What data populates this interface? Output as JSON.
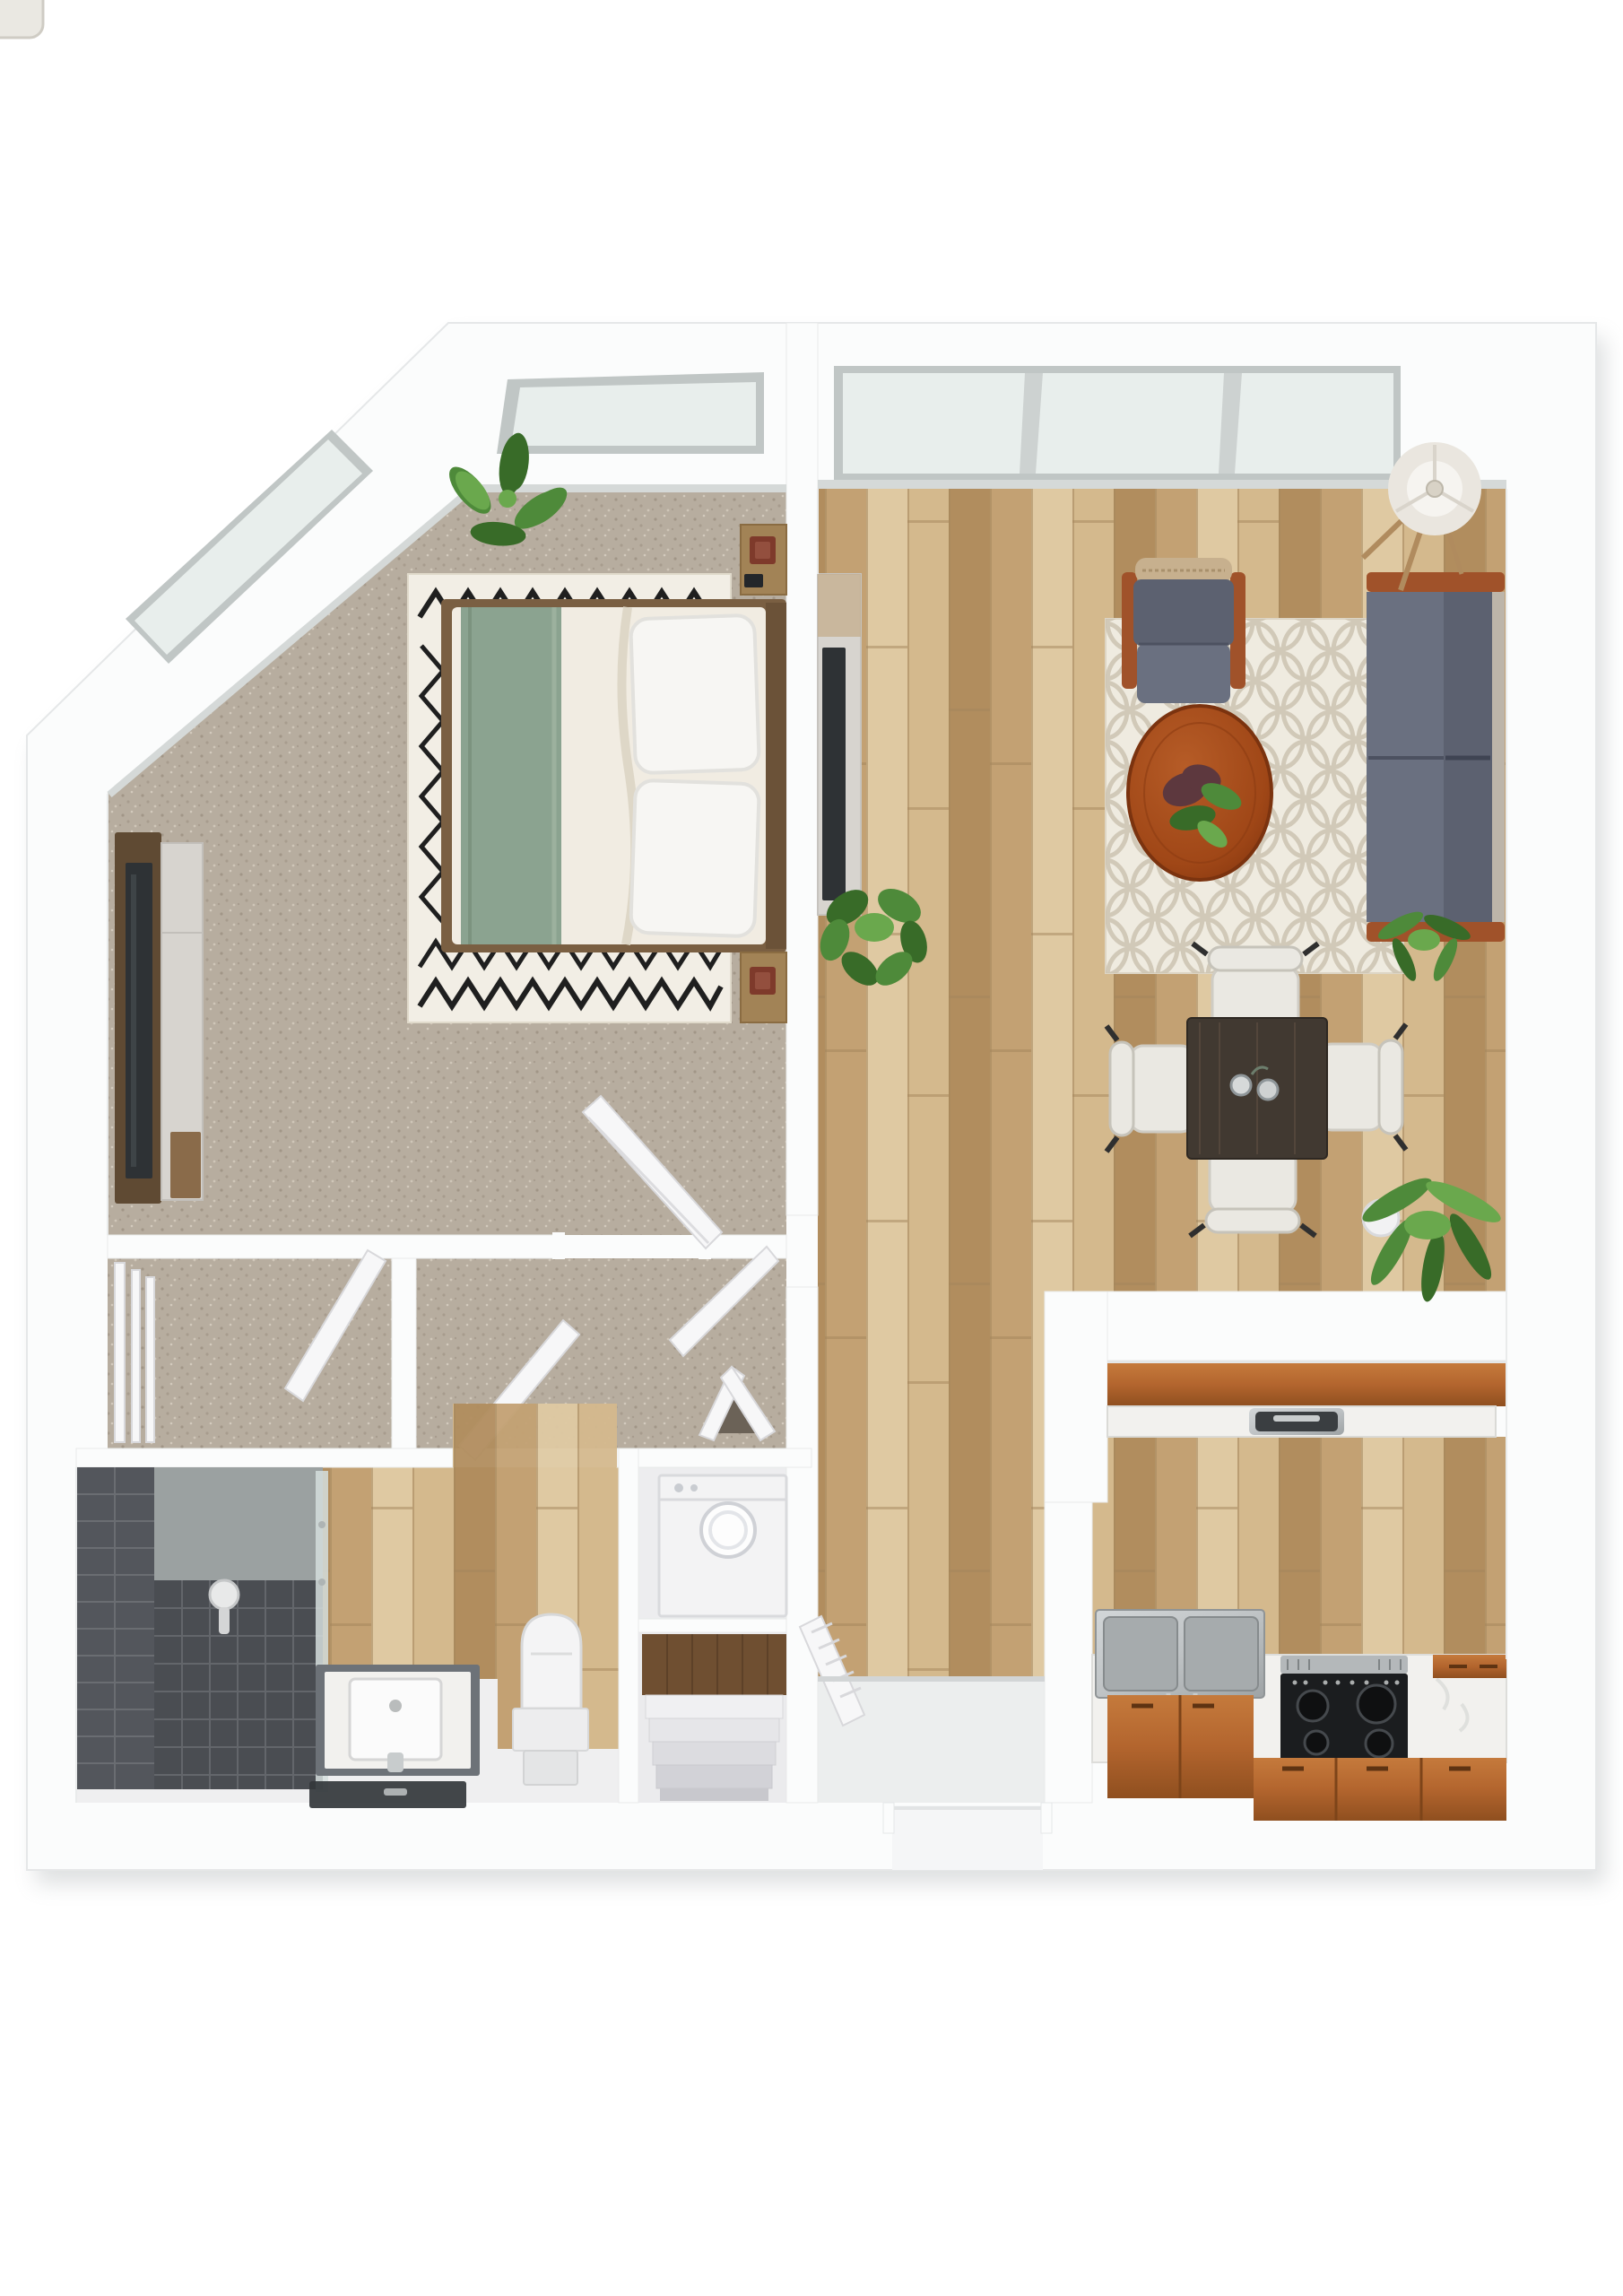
{
  "image_type": "3d-floor-plan-rendering",
  "visible_text": [],
  "palette": {
    "bg": "#ffffff",
    "wall": "#fbfcfc",
    "wall_edge": "#e5e7e8",
    "shadow": "#9aa0a3",
    "carpet": "#b7ad9f",
    "carpet_dot1": "#978c7d",
    "carpet_dot2": "#d9d1c4",
    "wood1": "#d4b98d",
    "wood2": "#c3a173",
    "wood3": "#b18d5e",
    "wood4": "#dfc9a2",
    "wood_joint": "#a3865c",
    "glass": "#e8eeec",
    "window_frame": "#c0c6c5",
    "sill": "#d5d9d8",
    "rug_bedroom": "#f2eee5",
    "rug_zigzag": "#1f1f1f",
    "rug_living": "#efebe0",
    "rug_trellis": "#ccc3b1",
    "sofa_gray": "#5c6170",
    "sofa_gray_light": "#6a7080",
    "sofa_side_fabric": "#bdb5a9",
    "frame_wood": "#a0522a",
    "chair_wicker": "#c7b08e",
    "bed_duvet": "#f1ece2",
    "bed_blanket": "#8ba390",
    "pillow": "#f7f6f3",
    "bed_frame": "#7a5f42",
    "headboard": "#6b5238",
    "nightstand_wood": "#a28356",
    "lamp_red": "#7e3a2b",
    "tv_screen": "#2e3235",
    "console_dark_wood": "#5f4a33",
    "console_light": "#d7d4cf",
    "marble": "#f2f1ee",
    "cabinet_orange": "#b3652e",
    "cabinet_orange_light": "#c57a3c",
    "cabinet_orange_dark": "#8f4f1f",
    "stainless": "#bfc3c5",
    "basin_steel": "#a6abad",
    "stove_black": "#1b1d1f",
    "burner": "#0f1011",
    "burner_ring": "#45494d",
    "door_white": "#f7f7f8",
    "door_edge": "#d8d8db",
    "toilet_white": "#f4f4f5",
    "washer_white": "#f3f3f4",
    "tile_dark": "#53565c",
    "tile_line": "#6a6d72",
    "tile_floor": "#4a4d52",
    "shower_glass": "#d5dedd",
    "vanity_base": "#6d7278",
    "plant_green1": "#4e8a3a",
    "plant_green2": "#386b28",
    "plant_green3": "#6aa84d",
    "plant_dark": "#5d383e",
    "dining_table": "#413931",
    "chair_white": "#eae8e2",
    "lamp_shade": "#eae6df",
    "stairs_wood": "#6f4f31",
    "entry_tile": "#eceeee"
  },
  "floor_plan": {
    "rooms": [
      {
        "name": "bedroom",
        "floor": "carpet",
        "features": [
          "chamfered-corner-wall",
          "skylight-window-diagonal",
          "skylight-window-top"
        ],
        "furniture": [
          "double-bed",
          "zigzag-area-rug",
          "nightstand-top",
          "nightstand-bottom",
          "table-lamp-red-top",
          "table-lamp-red-bottom",
          "tv-console",
          "wall-tv",
          "potted-plant",
          "open-door"
        ]
      },
      {
        "name": "living-room",
        "floor": "wood-planks",
        "features": [
          "panoramic-window-3-pane"
        ],
        "furniture": [
          "armchair",
          "loveseat-sofa",
          "round-coffee-table",
          "coffee-table-plant",
          "trellis-area-rug",
          "floor-lamp-ring",
          "tv-console",
          "wall-tv",
          "fiddle-leaf-plant",
          "small-palm-plant"
        ]
      },
      {
        "name": "dining-area",
        "floor": "wood-planks",
        "furniture": [
          "dining-table",
          "dining-chair-top",
          "dining-chair-bottom",
          "dining-chair-left",
          "dining-chair-right",
          "condiment-jars",
          "palm-plant"
        ]
      },
      {
        "name": "hallway",
        "floor": "carpet",
        "furniture": [
          "open-door-to-bathroom",
          "open-door-to-living",
          "bifold-door",
          "wood-threshold"
        ]
      },
      {
        "name": "closet",
        "floor": "carpet",
        "furniture": [
          "sliding-door-frames",
          "open-door"
        ]
      },
      {
        "name": "bathroom",
        "floor": "wood-and-tile",
        "furniture": [
          "walk-in-shower-dark-tile",
          "glass-shower-panel",
          "shower-fixture",
          "vanity-with-sink",
          "faucet",
          "dark-glass-ledge",
          "toilet"
        ]
      },
      {
        "name": "laundry-nook",
        "floor": "white",
        "furniture": [
          "top-load-washer"
        ]
      },
      {
        "name": "stair-nook",
        "floor": "white",
        "furniture": [
          "wood-landing",
          "descending-steps"
        ]
      },
      {
        "name": "entry",
        "floor": "tile",
        "features": [
          "front-door-opening",
          "step-edge"
        ],
        "furniture": [
          "open-louver-door"
        ]
      },
      {
        "name": "kitchen",
        "floor": "wood-planks",
        "furniture": [
          "peninsula-counter-orange",
          "peninsula-marble-top",
          "peninsula-sink-inset",
          "stainless-double-sink",
          "sink-faucet-handles",
          "electric-range-4-burners",
          "marble-countertop",
          "orange-base-cabinets",
          "drawer-handles"
        ]
      }
    ],
    "window_count": 4,
    "open_doors_count": 7
  }
}
